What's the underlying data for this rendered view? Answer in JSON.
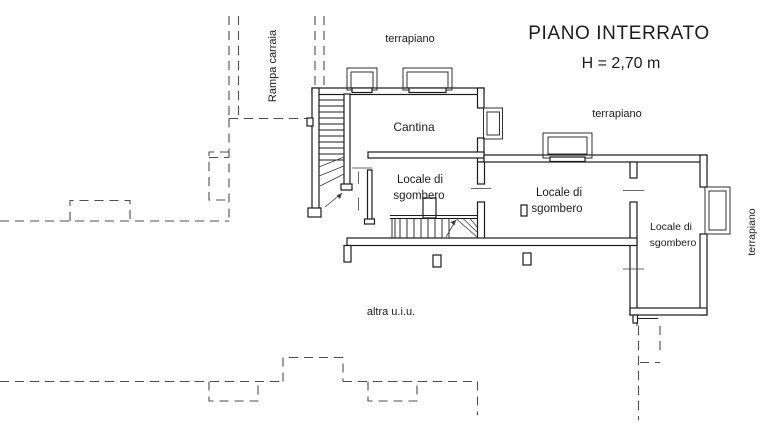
{
  "plan": {
    "title": "PIANO INTERRATO",
    "height_label": "H = 2,70 m",
    "rooms": [
      {
        "name": "Cantina"
      },
      {
        "line1": "Locale di",
        "line2": "sgombero"
      },
      {
        "line1": "Locale di",
        "line2": "sgombero"
      },
      {
        "line1": "Locale di",
        "line2": "sgombero"
      }
    ],
    "outdoor_labels": {
      "ramp": "Rampa carraia",
      "terrace_top": "terrapiano",
      "terrace_middle": "terrapiano",
      "terrace_right": "terrapiano",
      "other_unit": "altra u.i.u."
    },
    "colors": {
      "line": "#1c1c1c",
      "dashed_line": "#4f4f4f",
      "background": "#ffffff"
    }
  }
}
